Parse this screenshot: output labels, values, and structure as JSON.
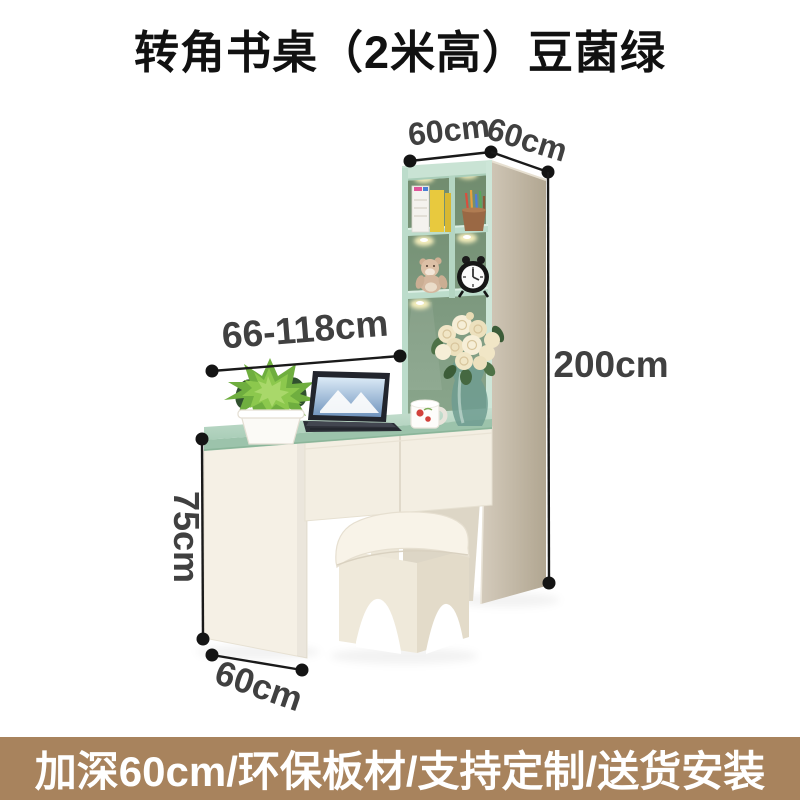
{
  "page": {
    "title": "转角书桌（2米高）豆菌绿",
    "background": "#ffffff"
  },
  "annotations": {
    "cabinet_depth_left": "60cm",
    "cabinet_depth_right": "60cm",
    "desk_width_range": "66-118cm",
    "total_height": "200cm",
    "desk_height": "75cm",
    "desk_depth": "60cm"
  },
  "banner": {
    "text": "加深60cm/环保板材/支持定制/送货安装",
    "background": "#a8835d",
    "color": "#ffffff"
  },
  "scene": {
    "items": [
      "bookshelf-cabinet",
      "corner-desk",
      "drawers",
      "stool",
      "potted-plant",
      "laptop",
      "coffee-mug",
      "flower-vase",
      "alarm-clock",
      "teddy-bear",
      "books",
      "pencil-cup",
      "shelf-lights"
    ],
    "colors": {
      "desk_top_green": "#aed2bc",
      "cabinet_side_beige": "#c2b8a5",
      "shelf_interior_green": "#7d997f",
      "shelf_frame_mint": "#bcdccb",
      "furniture_cream": "#f3eee2",
      "dimension_text": "#404040",
      "dimension_line": "#1a1a1a"
    }
  }
}
